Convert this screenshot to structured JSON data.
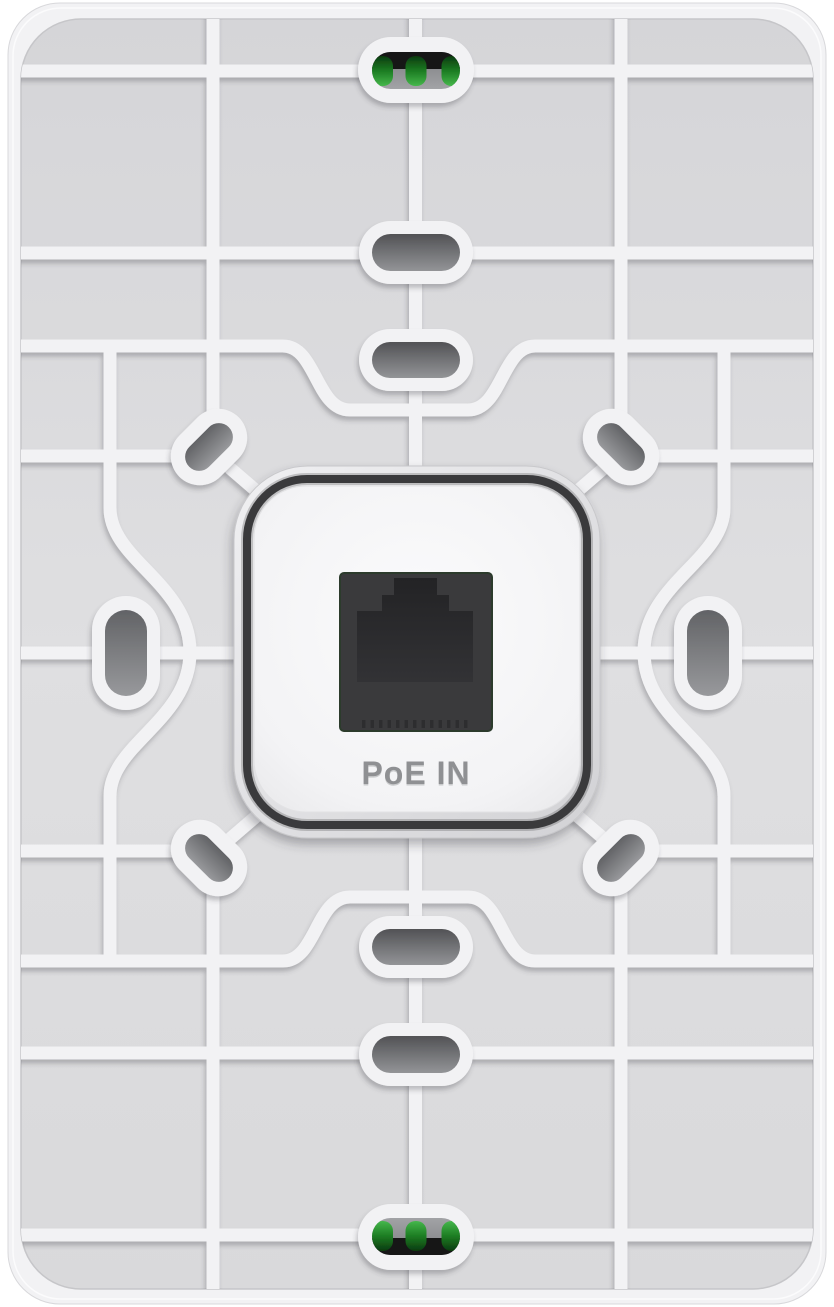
{
  "image": {
    "subject": "rear mounting plate of white in-wall access point",
    "background": "#ffffff"
  },
  "center_module": {
    "port_label": "PoE IN",
    "port": "rj45-jack"
  },
  "colors": {
    "plate_white": "#f2f2f4",
    "recess_gray": "#dbdbdd",
    "hole_gray": "#6c6d70",
    "groove_dark": "#3a3a3c",
    "port_body": "#3a3a3c",
    "port_cavity": "#28282a",
    "label_gray": "#8f9093",
    "pcb_green": "#1d7d23",
    "pcb_dark": "#141518"
  }
}
